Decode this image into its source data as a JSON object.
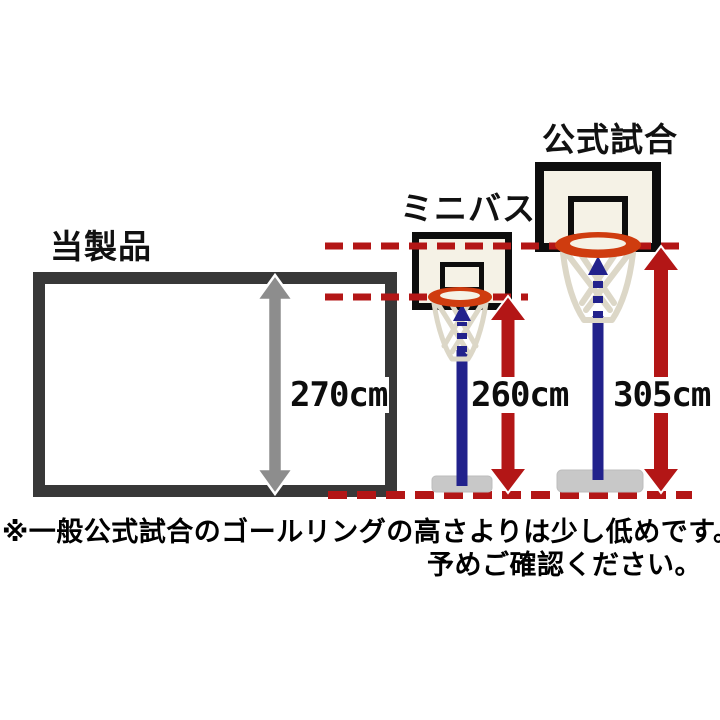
{
  "diagram": {
    "title": "バスケットゴール高さ比較",
    "figures": [
      {
        "id": "product",
        "label": "当製品",
        "height_label": "270cm",
        "height_cm": 270
      },
      {
        "id": "minibasket",
        "label": "ミニバス",
        "height_label": "260cm",
        "height_cm": 260
      },
      {
        "id": "official",
        "label": "公式試合",
        "height_label": "305cm",
        "height_cm": 305
      }
    ],
    "note": {
      "line1": "※一般公式試合のゴールリングの高さよりは少し低めです。",
      "line2": "予めご確認ください。"
    },
    "colors": {
      "measure_red": "#b31616",
      "pole_navy": "#22228c",
      "rim_orange": "#cf3c0f",
      "board_ivory": "#f5f2e6",
      "frame_charcoal": "#383838",
      "backboard_black": "#0d0d0d",
      "product_arrow_gray": "#8d8d8d",
      "base_gray": "#c8c8c8",
      "net_beige": "#dcd7c7"
    },
    "icons": [
      {
        "name": "double-arrow-vertical-gray-icon"
      },
      {
        "name": "double-arrow-vertical-red-icon"
      },
      {
        "name": "dashed-arrow-up-blue-icon"
      },
      {
        "name": "basketball-hoop-icon"
      }
    ]
  }
}
